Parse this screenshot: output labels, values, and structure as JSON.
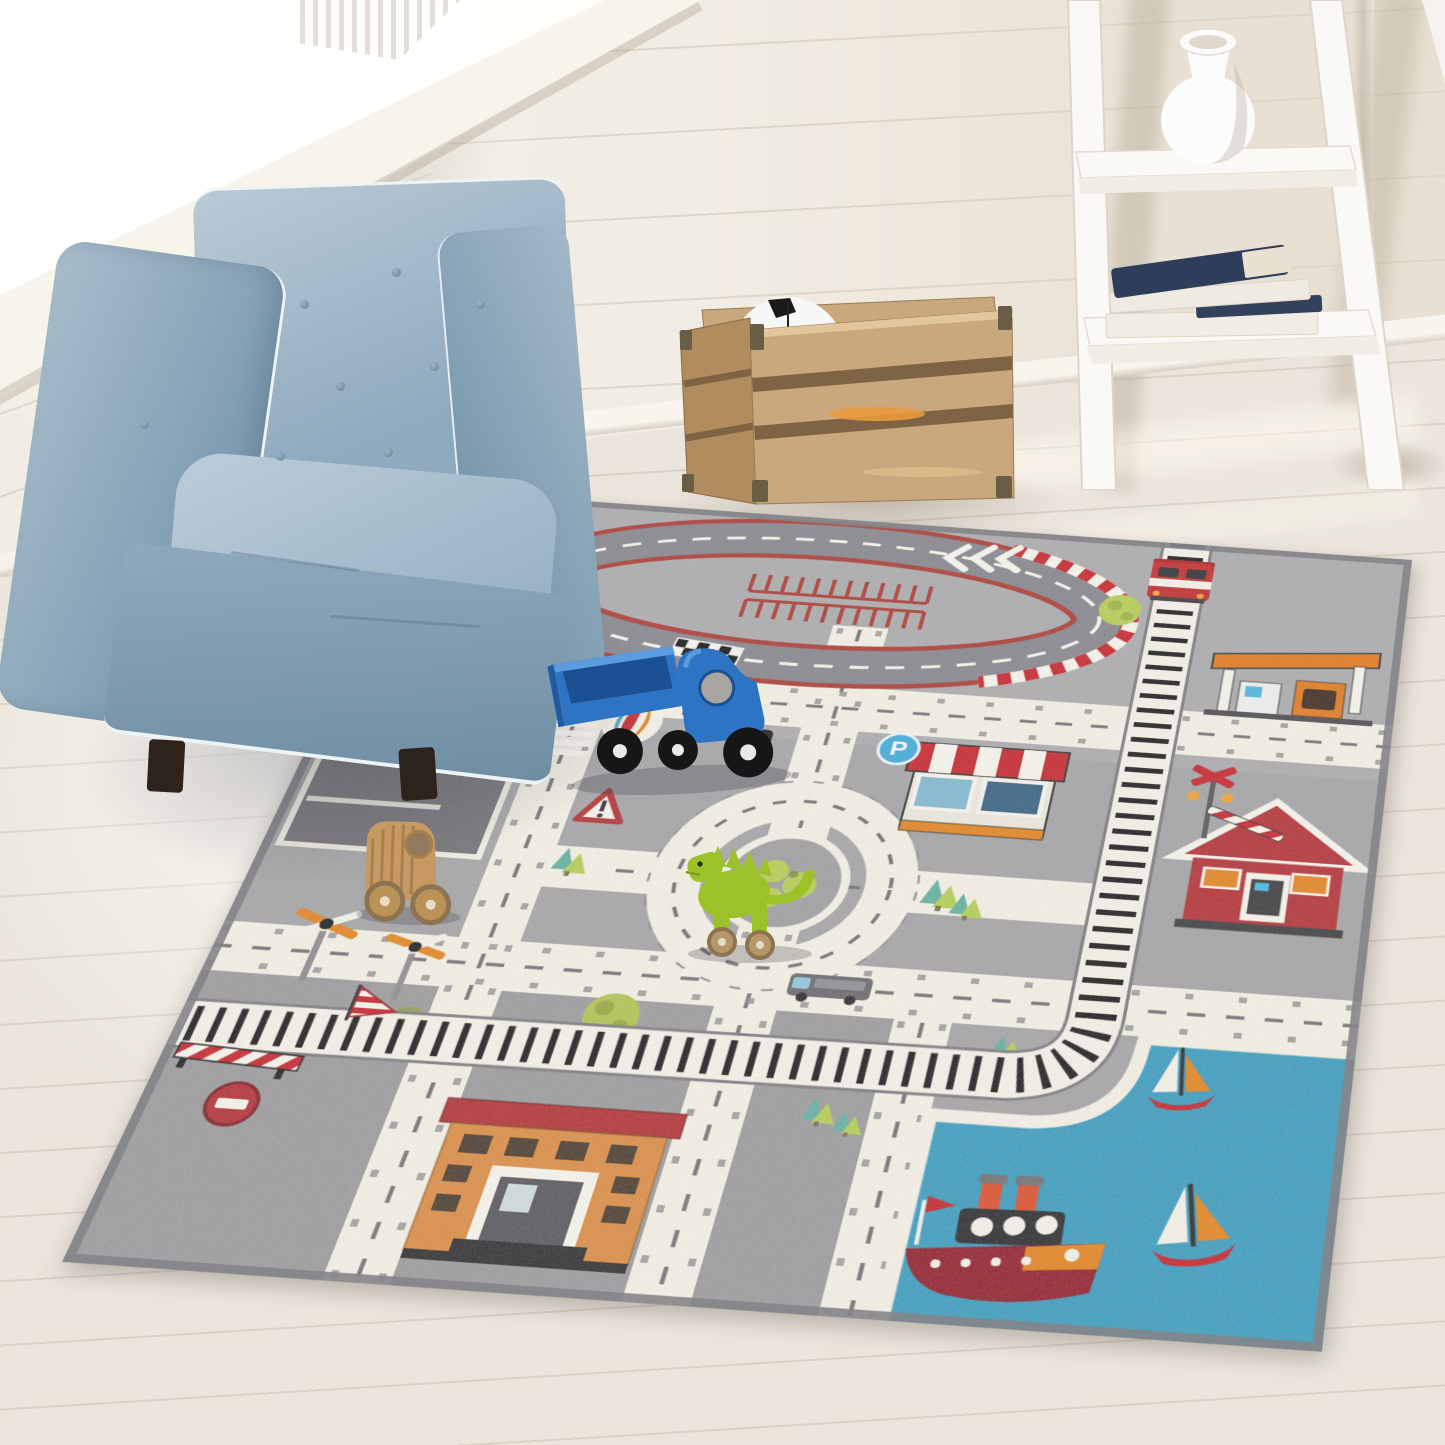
{
  "meta": {
    "description": "Photograph of a kids playroom corner: a light-blue tufted child armchair by a bright window, a wooden toy crate holding a soccer ball, a white leaning ladder shelf with a white vase and stacked books, all around a large gray children's city road-map play rug with toys on it."
  },
  "colors": {
    "wall": "#f2ede4",
    "window_light": "#fefefb",
    "floor": "#ebe5dc",
    "floor_line": "#d9d2c6",
    "chair_blue": "#8fa9bd",
    "chair_blue_light": "#b9cad6",
    "chair_blue_dark": "#6f8ea4",
    "chair_piping": "#eef3f6",
    "chair_feet": "#2e231b",
    "crate_wood": "#caa87e",
    "crate_wood_dark": "#8a6c49",
    "crate_glow": "#e89a3c",
    "soccer_ball_white": "#f7f7f7",
    "soccer_ball_black": "#1a1a1a",
    "shelf_white": "#faf8f4",
    "vase_white": "#fcfcfb",
    "book_navy": "#2e3d59",
    "book_pages": "#e9e2d2",
    "rug_gray": "#a2a2a4",
    "rug_road_cream": "#f2eee3",
    "rug_asphalt": "#85858a",
    "rug_red": "#a93a33",
    "rug_rail_dark": "#1c1c1c",
    "rug_water_teal": "#3a9abc",
    "rug_lime_green": "#b2cc52",
    "rug_teal_green": "#5fae9d",
    "rug_orange": "#e0821f",
    "rug_house_red": "#b03035",
    "rug_building_tan": "#d98a42",
    "rug_sign_blue": "#3fa8d8",
    "toy_truck_blue": "#2d74c4",
    "toy_wood": "#c79a63",
    "toy_dino_green": "#9cc229"
  },
  "room": {
    "window": "daylight window with deep white sill",
    "walls": "white shiplap plank walls",
    "floor": "whitewashed wood plank floor"
  },
  "furniture": {
    "armchair": {
      "label": "light blue tufted kids club chair with white piping and dark wood feet"
    },
    "crate": {
      "label": "natural wood slatted toy crate with metal corner brackets",
      "contents": "black and white soccer ball"
    },
    "ladder_shelf": {
      "label": "white leaning ladder shelf",
      "items": [
        "white ceramic vase",
        "stack of navy and white books"
      ]
    }
  },
  "rug": {
    "label": "gray kids city road play rug",
    "signs": {
      "parking_label": "P"
    },
    "features": [
      "oval race track with red-white curb, checkered start line, white chevron arrows and red pit marks",
      "hot air balloon",
      "train track running down and curving left",
      "red tram on the track",
      "gas station with orange canopy",
      "shop with red and white striped awning",
      "blue round parking sign",
      "red house with white trimmed roof",
      "railroad crossing sign with striped barrier",
      "central roundabout with green island",
      "teal harbor water with steamboat and two sailboats",
      "orange brick building",
      "dark parking lot with red vehicle",
      "two windmills with orange blades",
      "no-entry sign",
      "warning triangle sign",
      "traffic light",
      "red-white barrier fence and striped sail flag",
      "lime and teal trees",
      "cream roads with dashed markings"
    ]
  },
  "toys": [
    {
      "name": "blue wooden toy truck with open bed"
    },
    {
      "name": "natural wood toy car with big wheels"
    },
    {
      "name": "lime green wooden dinosaur pull toy"
    }
  ]
}
